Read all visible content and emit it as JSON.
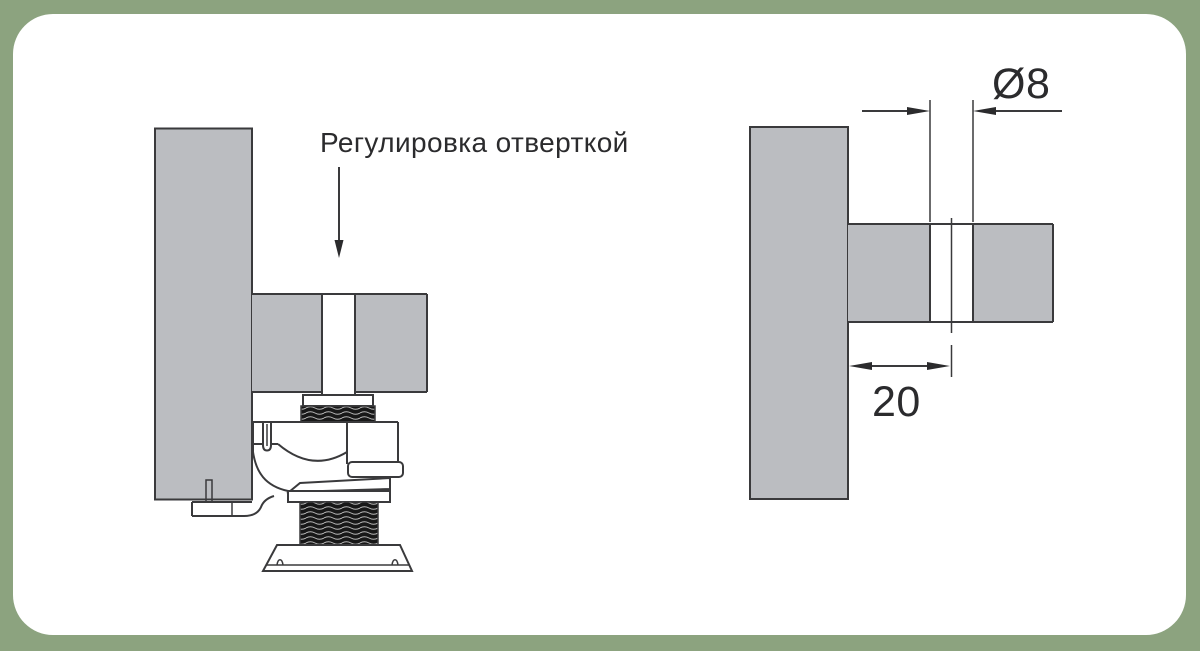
{
  "frame": {
    "background_color": "#8CA37F",
    "card_color": "#ffffff"
  },
  "colors": {
    "panel_fill": "#bbbdc1",
    "outline": "#3a3a3c",
    "thread_fill": "#181818",
    "text": "#2b2b2d"
  },
  "left_diagram": {
    "name": "adjustable-cabinet-leg-cross-section",
    "label": "Регулировка отверткой"
  },
  "right_diagram": {
    "name": "mounting-hole-dimensions",
    "dim_diameter": "Ø8",
    "dim_offset": "20"
  }
}
